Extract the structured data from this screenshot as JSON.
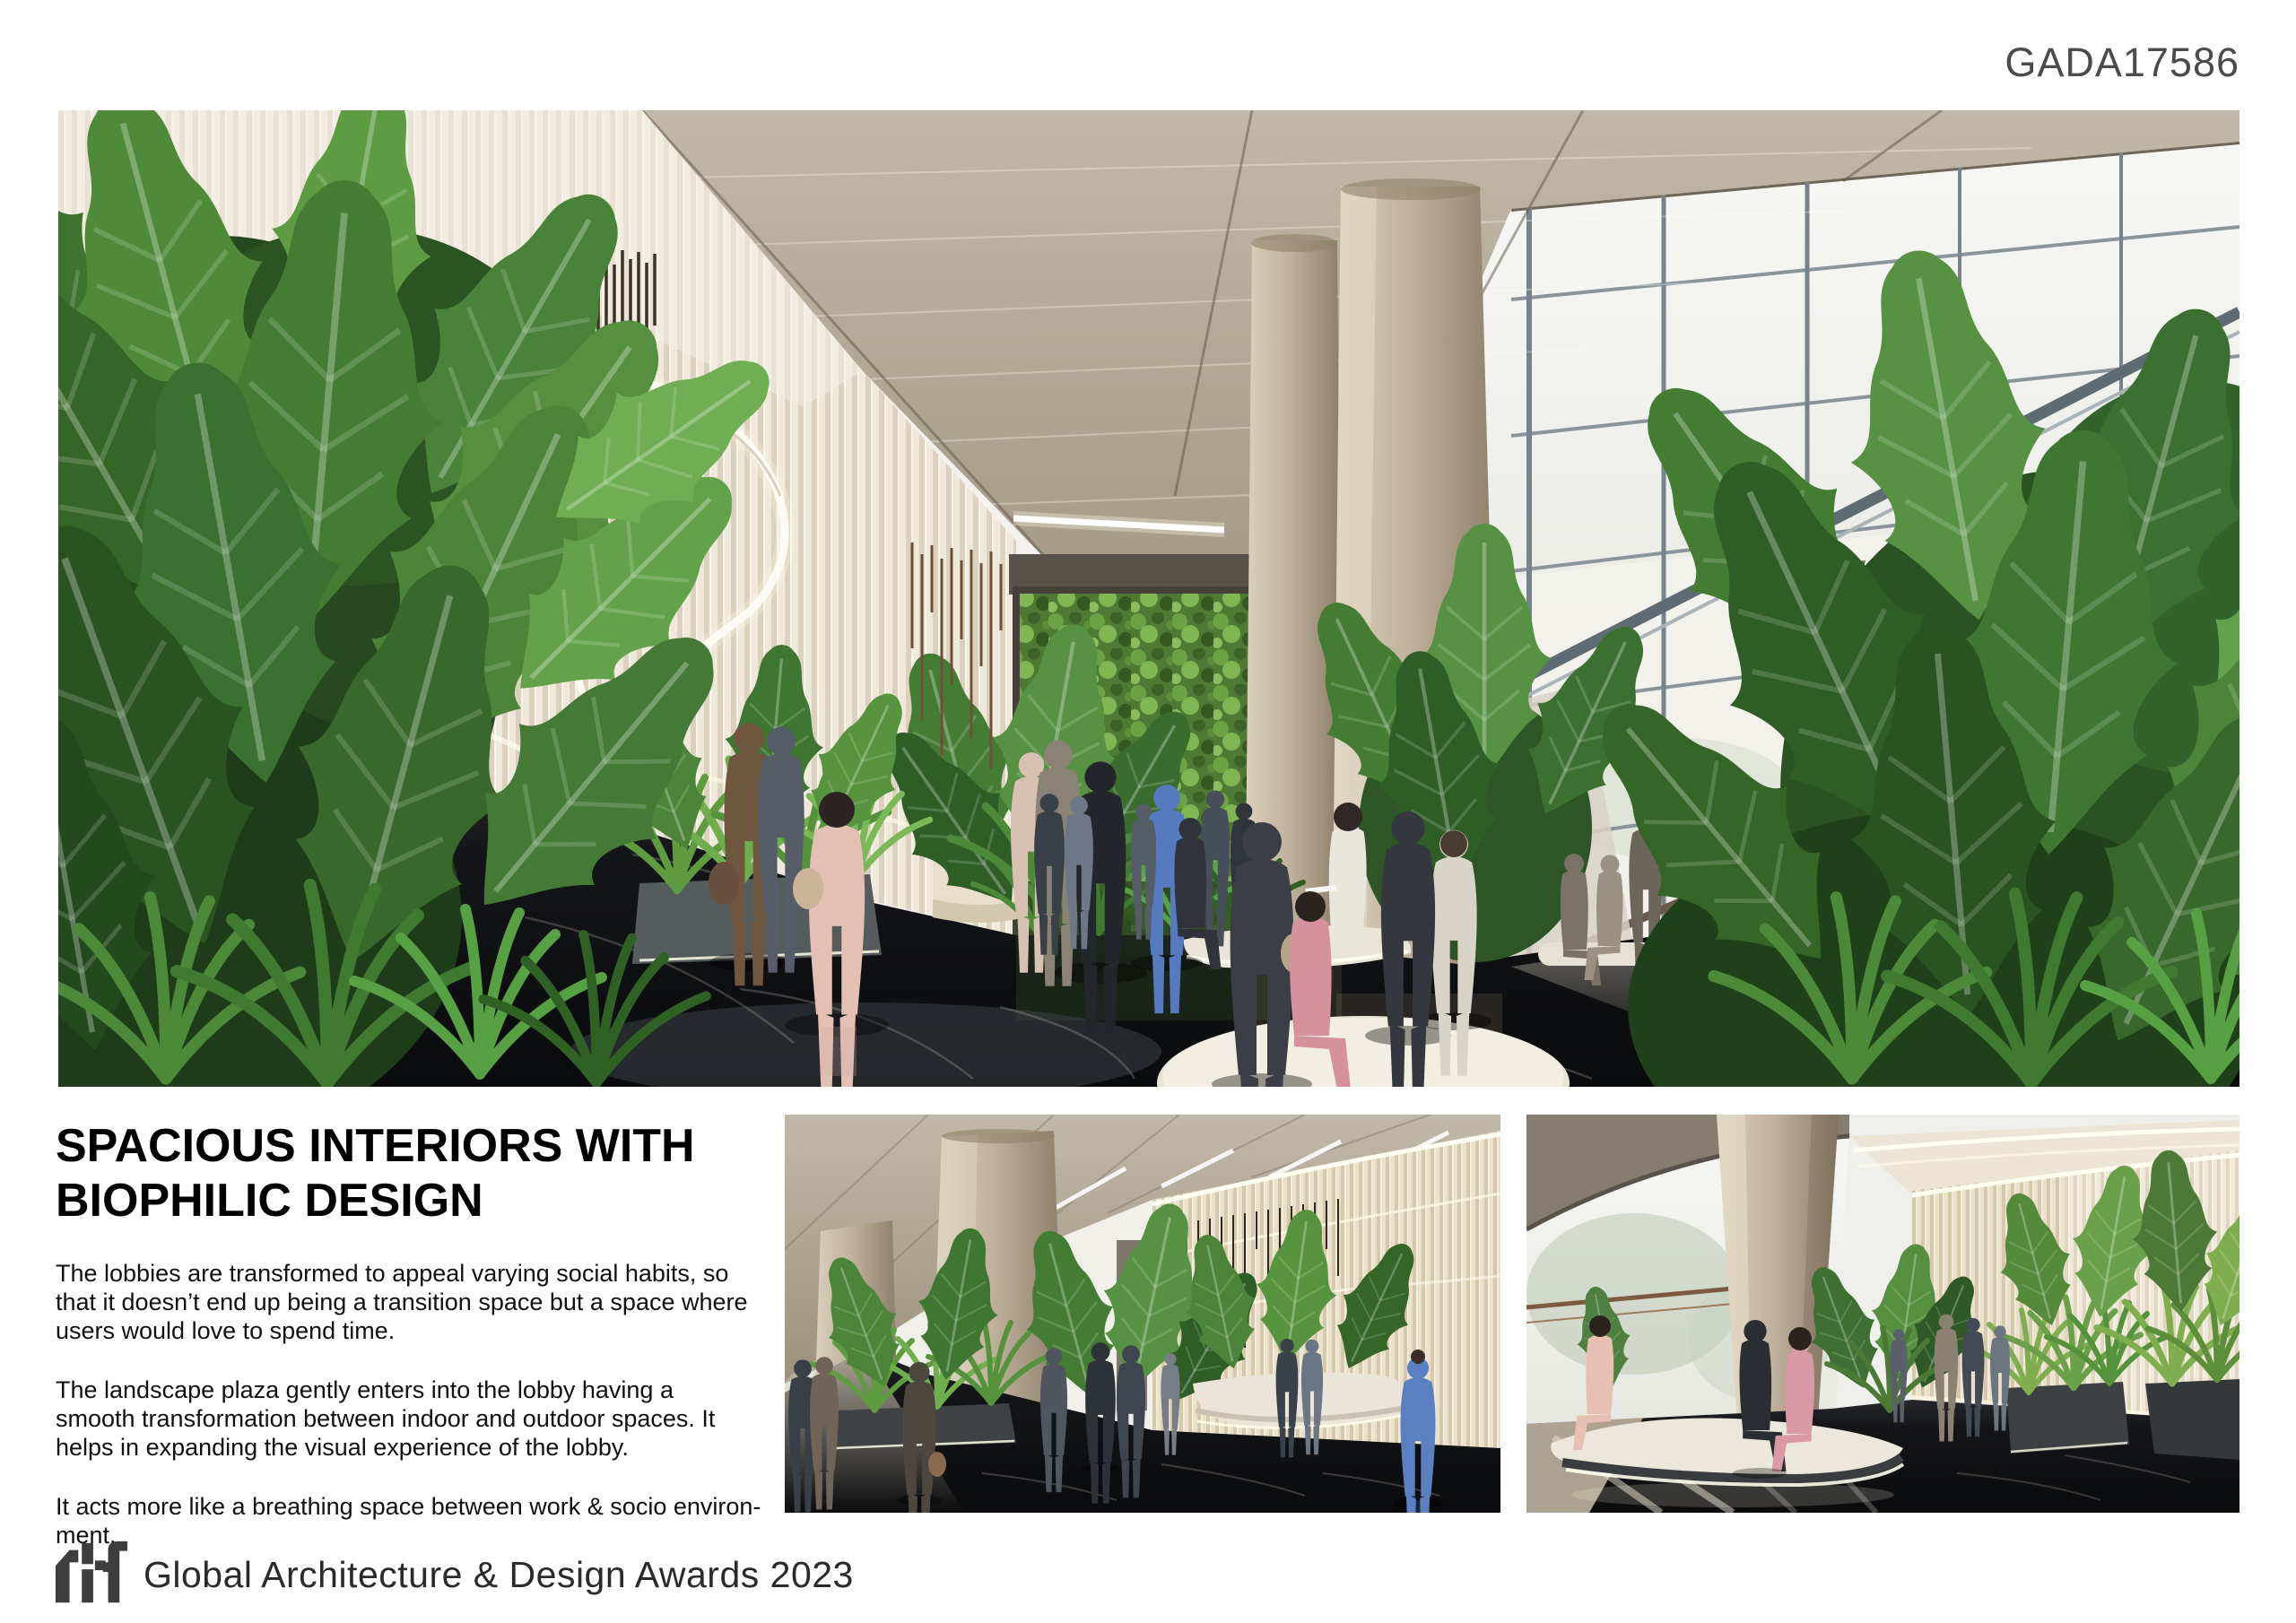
{
  "page": {
    "code": "GADA17586"
  },
  "content": {
    "heading": {
      "line1": "SPACIOUS INTERIORS WITH",
      "line2": "BIOPHILIC DESIGN"
    },
    "paragraphs": [
      {
        "lines": [
          "The lobbies are transformed to appeal varying social habits, so",
          "that it doesn’t end up being a transition space but a space where",
          "users would love to spend time."
        ]
      },
      {
        "lines": [
          "The landscape plaza gently enters into the lobby having a",
          "smooth transformation between indoor and outdoor spaces. It",
          "helps in expanding the visual experience of the lobby."
        ]
      },
      {
        "lines": [
          "It acts more like a breathing space between work & socio environ-",
          "ment."
        ]
      }
    ]
  },
  "footer": {
    "logo_text": "rtf",
    "award_title": "Global Architecture & Design Awards 2023"
  },
  "colors": {
    "page_bg": "#ffffff",
    "code_text": "#4b4b4b",
    "heading_text": "#000000",
    "body_text": "#111111",
    "footer_text": "#2a2a2a",
    "logo": "#3d3d3d",
    "foliage_green": "#4e7d39",
    "ceiling_beige": "#b0a490",
    "wall_cream": "#efe9dc",
    "marble_floor": "#121316"
  }
}
